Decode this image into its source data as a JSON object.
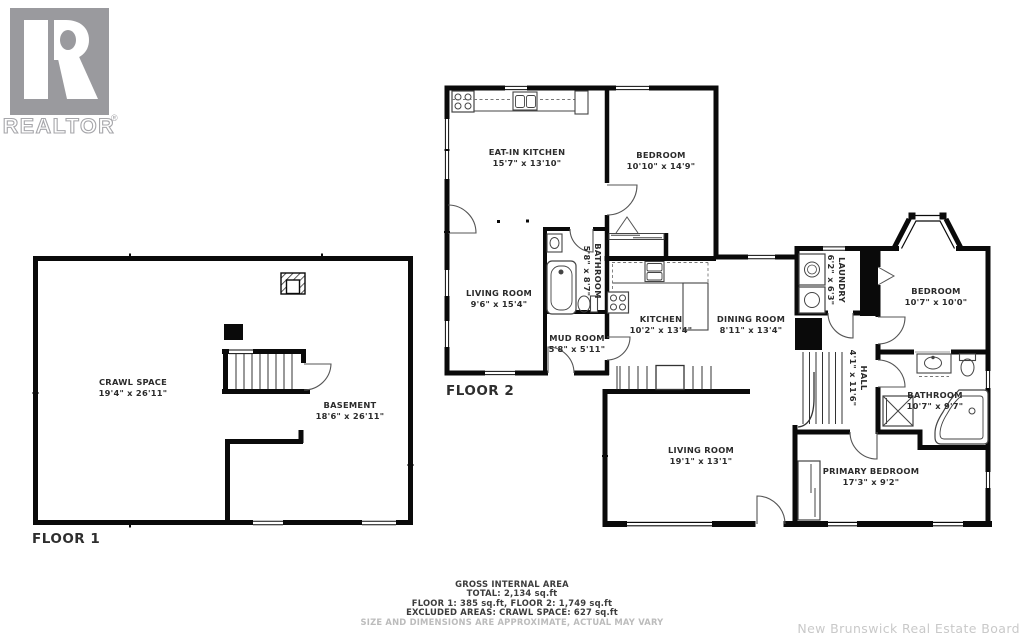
{
  "logo": {
    "name": "REALTOR",
    "registered": "®"
  },
  "floor1": {
    "label": "FLOOR 1",
    "rooms": {
      "crawl_space": {
        "name": "CRAWL SPACE",
        "dims": "19'4\" x 26'11\""
      },
      "basement": {
        "name": "BASEMENT",
        "dims": "18'6\" x 26'11\""
      }
    }
  },
  "floor2": {
    "label": "FLOOR 2",
    "rooms": {
      "eat_in_kitchen": {
        "name": "EAT-IN KITCHEN",
        "dims": "15'7\" x 13'10\""
      },
      "bedroom_top": {
        "name": "BEDROOM",
        "dims": "10'10\" x 14'9\""
      },
      "living_room_upper": {
        "name": "LIVING ROOM",
        "dims": "9'6\" x 15'4\""
      },
      "bathroom_upper": {
        "name": "BATHROOM",
        "dims": "5'8\" x 8'7\""
      },
      "mud_room": {
        "name": "MUD ROOM",
        "dims": "5'8\" x 5'11\""
      },
      "kitchen": {
        "name": "KITCHEN",
        "dims": "10'2\" x 13'4\""
      },
      "dining_room": {
        "name": "DINING ROOM",
        "dims": "8'11\" x 13'4\""
      },
      "laundry": {
        "name": "LAUNDRY",
        "dims": "6'2\" x 6'3\""
      },
      "hall": {
        "name": "HALL",
        "dims": "4'1\" x 11'6\""
      },
      "bedroom_right": {
        "name": "BEDROOM",
        "dims": "10'7\" x 10'0\""
      },
      "bathroom_right": {
        "name": "BATHROOM",
        "dims": "10'7\" x 9'7\""
      },
      "living_room_main": {
        "name": "LIVING ROOM",
        "dims": "19'1\" x 13'1\""
      },
      "primary_bedroom": {
        "name": "PRIMARY BEDROOM",
        "dims": "17'3\" x 9'2\""
      }
    }
  },
  "summary": {
    "title": "GROSS INTERNAL AREA",
    "total": "TOTAL: 2,134 sq.ft",
    "floors": "FLOOR 1: 385 sq.ft, FLOOR 2: 1,749 sq.ft",
    "excluded": "EXCLUDED AREAS: CRAWL SPACE: 627 sq.ft",
    "disclaimer": "SIZE AND DIMENSIONS ARE APPROXIMATE, ACTUAL MAY VARY"
  },
  "watermark": "New Brunswick Real Estate Board",
  "colors": {
    "wall": "#0a0a0a",
    "fixture": "#4a4a4a",
    "logo_gray": "#9a9a9e",
    "text": "#2b2b2b",
    "muted": "#bcbcbc",
    "watermark_gray": "#c9c9c9"
  }
}
